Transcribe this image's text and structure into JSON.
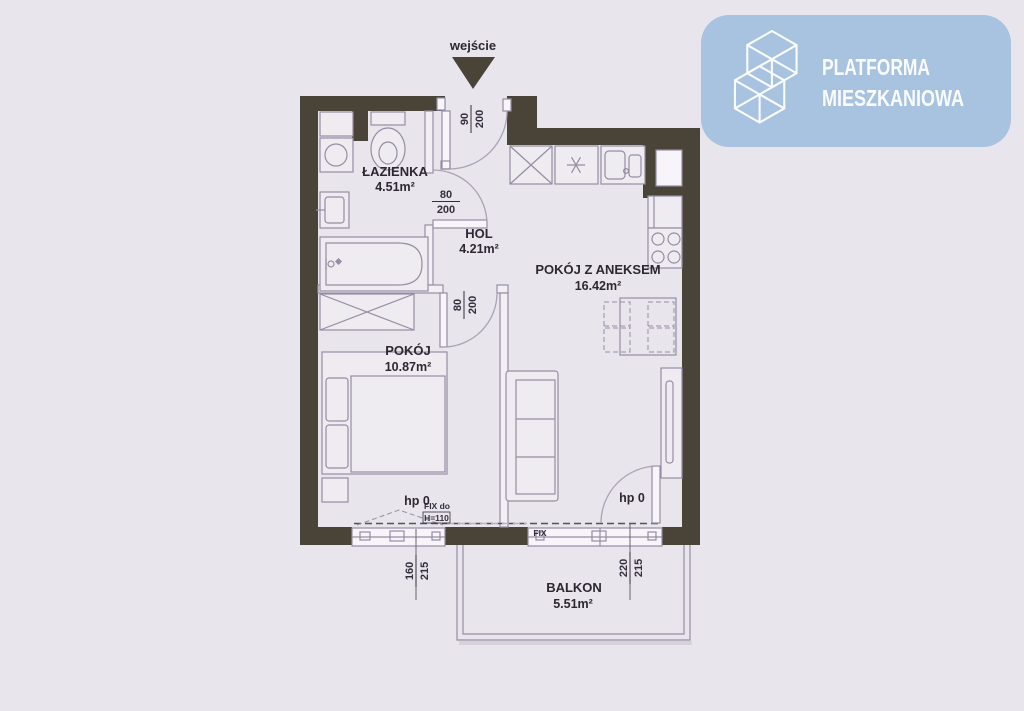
{
  "colors": {
    "background": "#e9e5ec",
    "wall": "#4a4338",
    "line": "#958da3",
    "label_text": "#2c2732",
    "logo_background": "#a7c3e0",
    "logo_foreground": "#fafbfd"
  },
  "logo": {
    "icon": "building-lattice-icon",
    "line1": "PLATFORMA",
    "line2": "MIESZKANIOWA"
  },
  "entrance": {
    "label": "wejście",
    "dim": {
      "num": "90",
      "den": "200"
    }
  },
  "rooms": {
    "lazienka": {
      "name": "ŁAZIENKA",
      "area": "4.51m²"
    },
    "hol": {
      "name": "HOL",
      "area": "4.21m²"
    },
    "aneks": {
      "name": "POKÓJ Z ANEKSEM",
      "area": "16.42m²"
    },
    "pokoj": {
      "name": "POKÓJ",
      "area": "10.87m²"
    },
    "balkon": {
      "name": "BALKON",
      "area": "5.51m²"
    }
  },
  "doors": {
    "bathroom": {
      "num": "80",
      "den": "200"
    },
    "bedroom": {
      "num": "80",
      "den": "200"
    }
  },
  "windows": {
    "pokoj": {
      "sill": "hp 0",
      "num": "160",
      "den": "215",
      "fix_label": "FIX do",
      "fix_height": "H=110"
    },
    "balkon": {
      "sill": "hp 0",
      "num": "220",
      "den": "215",
      "fix_label": "FIX"
    }
  }
}
